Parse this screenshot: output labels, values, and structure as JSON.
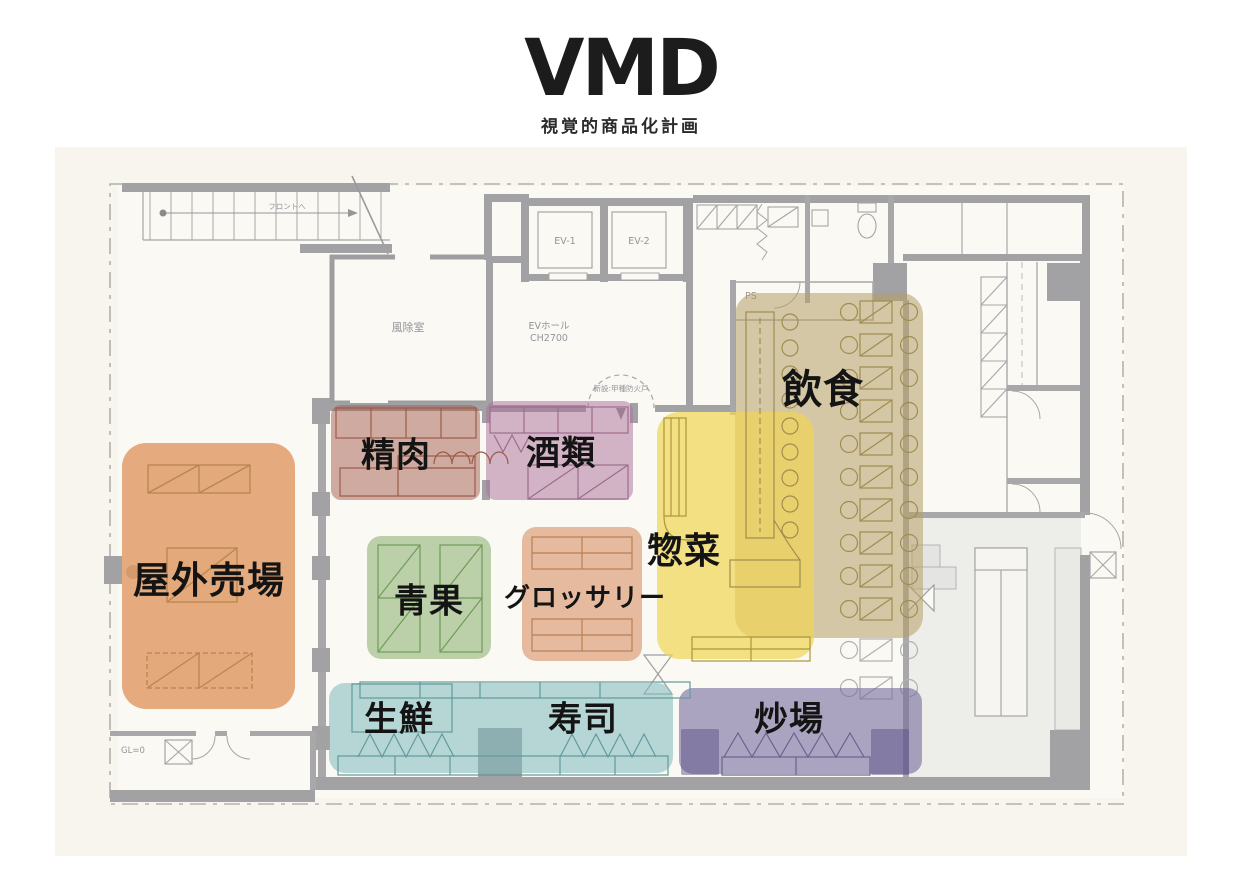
{
  "title": {
    "main": "VMD",
    "subtitle": "視覚的商品化計画"
  },
  "plan": {
    "ev1": "EV-1",
    "ev2": "EV-2",
    "ev_hall_line1": "EVホール",
    "ev_hall_line2": "CH2700",
    "vestibule": "風除室",
    "ps": "PS",
    "gl": "GL=0",
    "fire_door": "新設:甲種防火戸",
    "stair_note": "フロントへ"
  },
  "zones": [
    {
      "id": "outdoor",
      "x": 122,
      "y": 443,
      "w": 173,
      "h": 266,
      "r": 24,
      "color": "rgba(225,156,104,0.85)"
    },
    {
      "id": "meat",
      "x": 331,
      "y": 405,
      "w": 149,
      "h": 95,
      "r": 10,
      "color": "rgba(166,98,82,0.52)"
    },
    {
      "id": "alcohol",
      "x": 486,
      "y": 401,
      "w": 147,
      "h": 99,
      "r": 10,
      "color": "rgba(173,115,155,0.52)"
    },
    {
      "id": "produce",
      "x": 367,
      "y": 536,
      "w": 124,
      "h": 123,
      "r": 14,
      "color": "rgba(134,175,105,0.55)"
    },
    {
      "id": "grocery",
      "x": 522,
      "y": 527,
      "w": 120,
      "h": 134,
      "r": 14,
      "color": "rgba(213,134,88,0.55)"
    },
    {
      "id": "dining",
      "x": 735,
      "y": 293,
      "w": 188,
      "h": 345,
      "r": 22,
      "color": "rgba(180,158,100,0.55)"
    },
    {
      "id": "souzai",
      "x": 657,
      "y": 412,
      "w": 157,
      "h": 247,
      "r": 22,
      "color": "rgba(240,214,86,0.72)"
    },
    {
      "id": "fresh-sushi",
      "x": 329,
      "y": 683,
      "w": 344,
      "h": 90,
      "r": 16,
      "color": "rgba(125,185,188,0.55)"
    },
    {
      "id": "stir",
      "x": 679,
      "y": 688,
      "w": 243,
      "h": 86,
      "r": 14,
      "color": "rgba(118,107,156,0.6)"
    },
    {
      "id": "stir-block-left",
      "x": 681,
      "y": 729,
      "w": 38,
      "h": 46,
      "r": 2,
      "color": "rgba(84,74,130,0.45)"
    },
    {
      "id": "stir-block-right",
      "x": 871,
      "y": 729,
      "w": 38,
      "h": 46,
      "r": 2,
      "color": "rgba(84,74,130,0.45)"
    }
  ],
  "zone_labels": [
    {
      "id": "outdoor",
      "text": "屋外売場",
      "x": 209,
      "y": 577,
      "size": 37
    },
    {
      "id": "meat",
      "text": "精肉",
      "x": 396,
      "y": 452,
      "size": 34
    },
    {
      "id": "alcohol",
      "text": "酒類",
      "x": 561,
      "y": 450,
      "size": 34
    },
    {
      "id": "produce",
      "text": "青果",
      "x": 429,
      "y": 598,
      "size": 34
    },
    {
      "id": "grocery",
      "text": "グロッサリー",
      "x": 585,
      "y": 596,
      "size": 26
    },
    {
      "id": "souzai",
      "text": "惣菜",
      "x": 684,
      "y": 548,
      "size": 36
    },
    {
      "id": "dining",
      "text": "飲食",
      "x": 823,
      "y": 386,
      "size": 40
    },
    {
      "id": "fresh",
      "text": "生鮮",
      "x": 399,
      "y": 716,
      "size": 34
    },
    {
      "id": "sushi",
      "text": "寿司",
      "x": 583,
      "y": 716,
      "size": 34
    },
    {
      "id": "stir",
      "text": "炒場",
      "x": 789,
      "y": 716,
      "size": 34
    }
  ]
}
